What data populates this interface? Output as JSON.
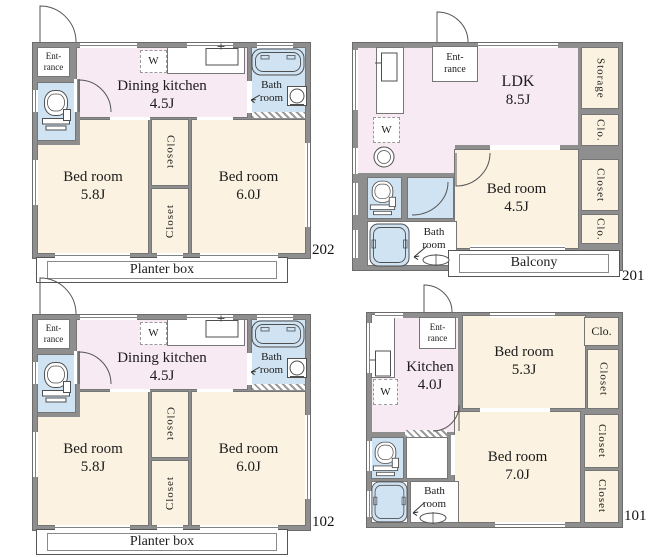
{
  "colors": {
    "wall": "#8e8e8e",
    "room_pink": "#f8eaf2",
    "room_beige": "#fbf2e1",
    "room_blue": "#d0e3f3",
    "fixture_line": "#4f4f4f"
  },
  "units": {
    "u202": {
      "number": "202",
      "entrance1": "Ent-",
      "entrance2": "rance",
      "dining_kitchen1": "Dining kitchen",
      "dining_kitchen2": "4.5J",
      "washer": "W",
      "bath1": "Bath",
      "bath2": "room",
      "bed_left1": "Bed room",
      "bed_left2": "5.8J",
      "bed_right1": "Bed room",
      "bed_right2": "6.0J",
      "closet_top": "Closet",
      "closet_bottom": "Closet",
      "planter": "Planter box"
    },
    "u201": {
      "number": "201",
      "entrance1": "Ent-",
      "entrance2": "rance",
      "ldk1": "LDK",
      "ldk2": "8.5J",
      "washer": "W",
      "storage": "Storage",
      "clo_top": "Clo.",
      "closet": "Closet",
      "clo_bottom": "Clo.",
      "bed1": "Bed room",
      "bed2": "4.5J",
      "bath1": "Bath",
      "bath2": "room",
      "balcony": "Balcony"
    },
    "u102": {
      "number": "102",
      "entrance1": "Ent-",
      "entrance2": "rance",
      "dining_kitchen1": "Dining kitchen",
      "dining_kitchen2": "4.5J",
      "washer": "W",
      "bath1": "Bath",
      "bath2": "room",
      "bed_left1": "Bed room",
      "bed_left2": "5.8J",
      "bed_right1": "Bed room",
      "bed_right2": "6.0J",
      "closet_top": "Closet",
      "closet_bottom": "Closet",
      "planter": "Planter box"
    },
    "u101": {
      "number": "101",
      "entrance1": "Ent-",
      "entrance2": "rance",
      "kitchen1": "Kitchen",
      "kitchen2": "4.0J",
      "washer": "W",
      "clo": "Clo.",
      "closet_top": "Closet",
      "closet_mid": "Closet",
      "closet_bottom": "Closet",
      "bed_top1": "Bed room",
      "bed_top2": "5.3J",
      "bed_bottom1": "Bed room",
      "bed_bottom2": "7.0J",
      "bath1": "Bath",
      "bath2": "room"
    }
  }
}
